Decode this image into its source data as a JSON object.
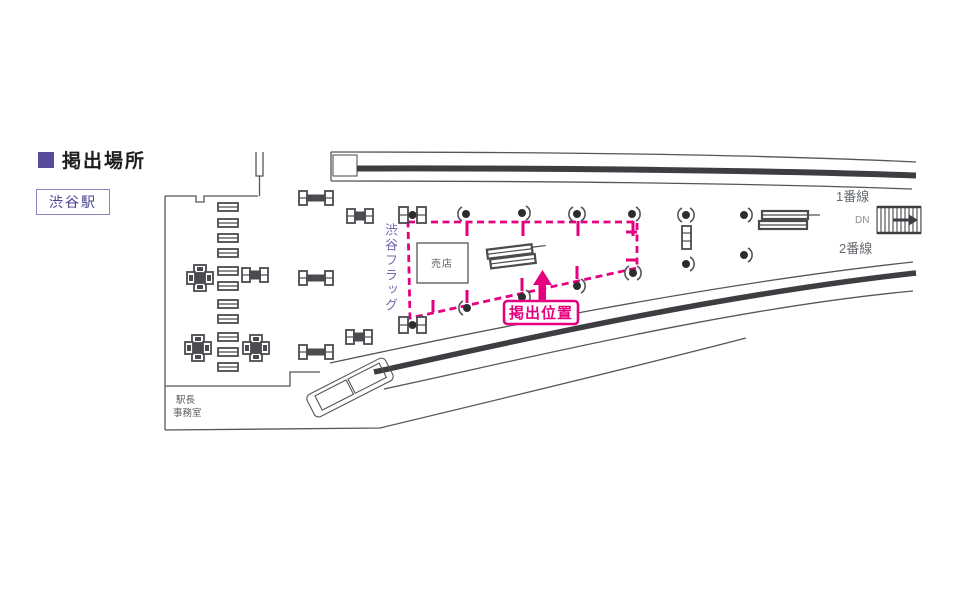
{
  "header": {
    "title": "掲出場所",
    "station": "渋谷駅"
  },
  "map": {
    "flag_area_label": "渋谷フラッグ",
    "position_label": "掲出位置",
    "kiosk_label": "売店",
    "office_label": [
      "駅長",
      "事務室"
    ],
    "track1_label": "1番線",
    "track2_label": "2番線",
    "stairs_label": "DN"
  },
  "colors": {
    "accent_purple": "#584c9d",
    "label_purple": "#6f69b0",
    "highlight_pink": "#e5007f",
    "line_gray": "#55565a"
  }
}
